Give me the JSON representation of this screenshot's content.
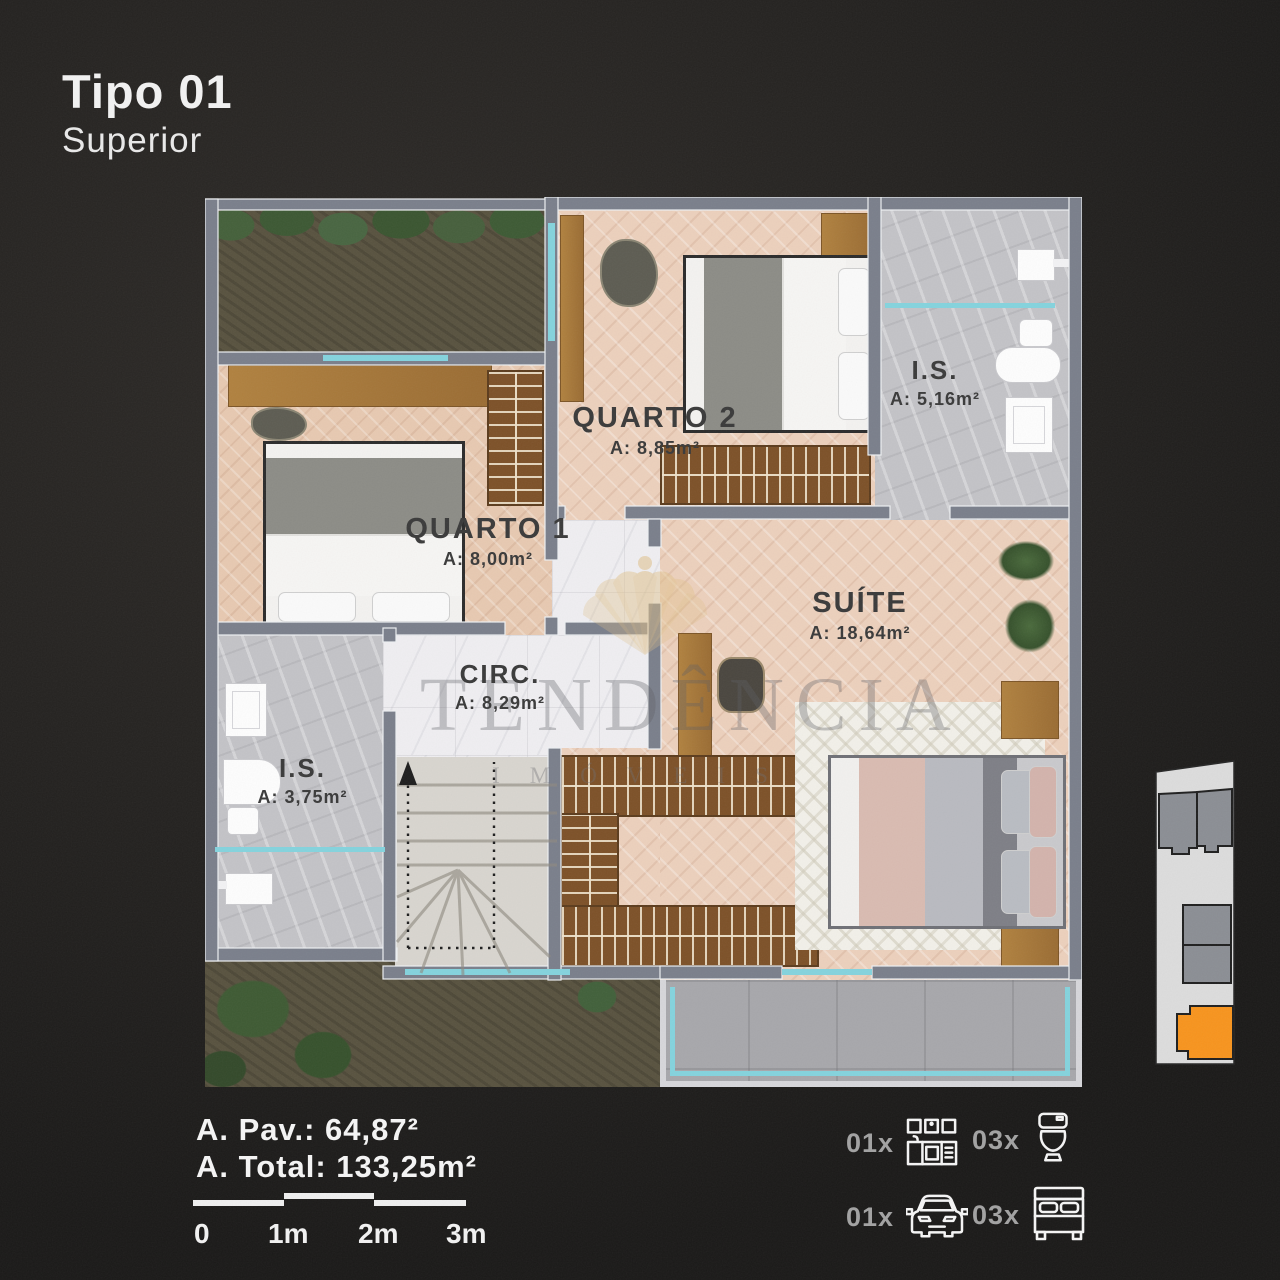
{
  "title": {
    "main": "Tipo 01",
    "sub": "Superior"
  },
  "watermark": {
    "brand": "TENDÊNCIA",
    "sub": "IMÓVEIS"
  },
  "rooms": [
    {
      "name": "QUARTO 2",
      "area": "A: 8,85m²"
    },
    {
      "name": "I.S.",
      "area": "A: 5,16m²"
    },
    {
      "name": "QUARTO 1",
      "area": "A: 8,00m²"
    },
    {
      "name": "SUÍTE",
      "area": "A: 18,64m²"
    },
    {
      "name": "CIRC.",
      "area": "A: 8,29m²"
    },
    {
      "name": "I.S.",
      "area": "A: 3,75m²"
    }
  ],
  "stats": {
    "pav": "A. Pav.: 64,87²",
    "total": "A. Total: 133,25m²"
  },
  "scalebar": {
    "labels": [
      "0",
      "1m",
      "2m",
      "3m"
    ]
  },
  "legend": [
    {
      "count": "01x",
      "icon": "kitchen-icon"
    },
    {
      "count": "03x",
      "icon": "toilet-icon"
    },
    {
      "count": "01x",
      "icon": "car-icon"
    },
    {
      "count": "03x",
      "icon": "bed-icon"
    }
  ],
  "colors": {
    "accent": "#f7941e",
    "gold": "#dfc08a",
    "glass": "#84d3dd",
    "wall": "#7a7f8b"
  }
}
